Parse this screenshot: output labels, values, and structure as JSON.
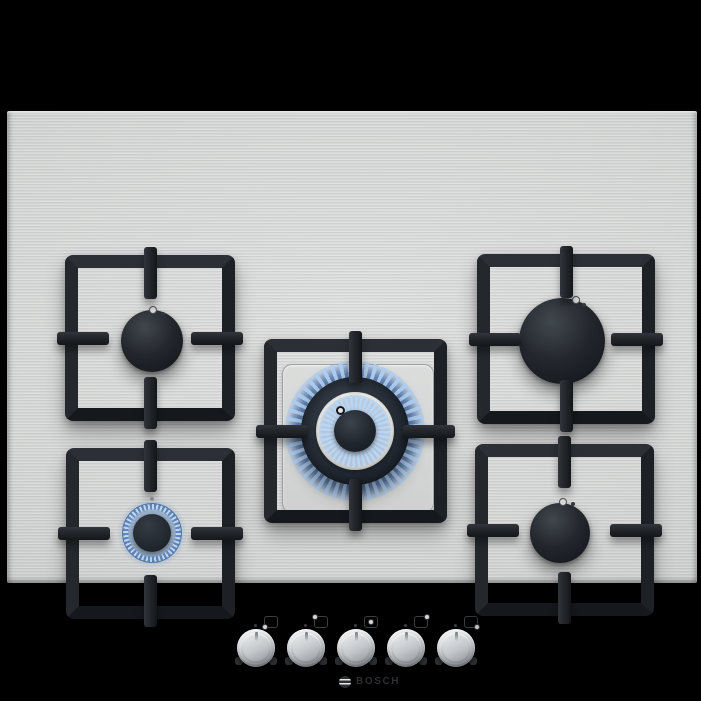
{
  "image": {
    "kind": "product photograph",
    "subject": "stainless steel 5-burner gas cooktop, top view",
    "background_color": "#000000"
  },
  "brand": {
    "text": "BOSCH",
    "symbol": "bosch-armature-icon",
    "color": "#2c2f31"
  },
  "surface": {
    "material": "brushed stainless steel",
    "base_color": "#d3d5d4"
  },
  "burners": [
    {
      "position": "top-left",
      "size": "medium",
      "state": "off"
    },
    {
      "position": "top-right",
      "size": "large",
      "state": "off"
    },
    {
      "position": "center",
      "size": "dual-ring wok",
      "state": "on",
      "flame_color": "#9cc0e8"
    },
    {
      "position": "bottom-left",
      "size": "small",
      "state": "on",
      "flame_color": "#9cc0e8"
    },
    {
      "position": "bottom-right",
      "size": "medium",
      "state": "off"
    }
  ],
  "controls": {
    "knob_count": 5,
    "knobs": [
      {
        "index": 1,
        "controls_burner": "bottom-left",
        "icon": "burner-position-bottom-left-icon"
      },
      {
        "index": 2,
        "controls_burner": "top-left",
        "icon": "burner-position-top-left-icon"
      },
      {
        "index": 3,
        "controls_burner": "center",
        "icon": "burner-position-center-icon"
      },
      {
        "index": 4,
        "controls_burner": "top-right",
        "icon": "burner-position-top-right-icon"
      },
      {
        "index": 5,
        "controls_burner": "bottom-right",
        "icon": "burner-position-bottom-right-icon"
      }
    ],
    "knob_color": "#c6cacd"
  },
  "colors": {
    "grate": "#1e2126",
    "flame": "#9cc0e8",
    "burner_cap": "#1b1f24"
  }
}
